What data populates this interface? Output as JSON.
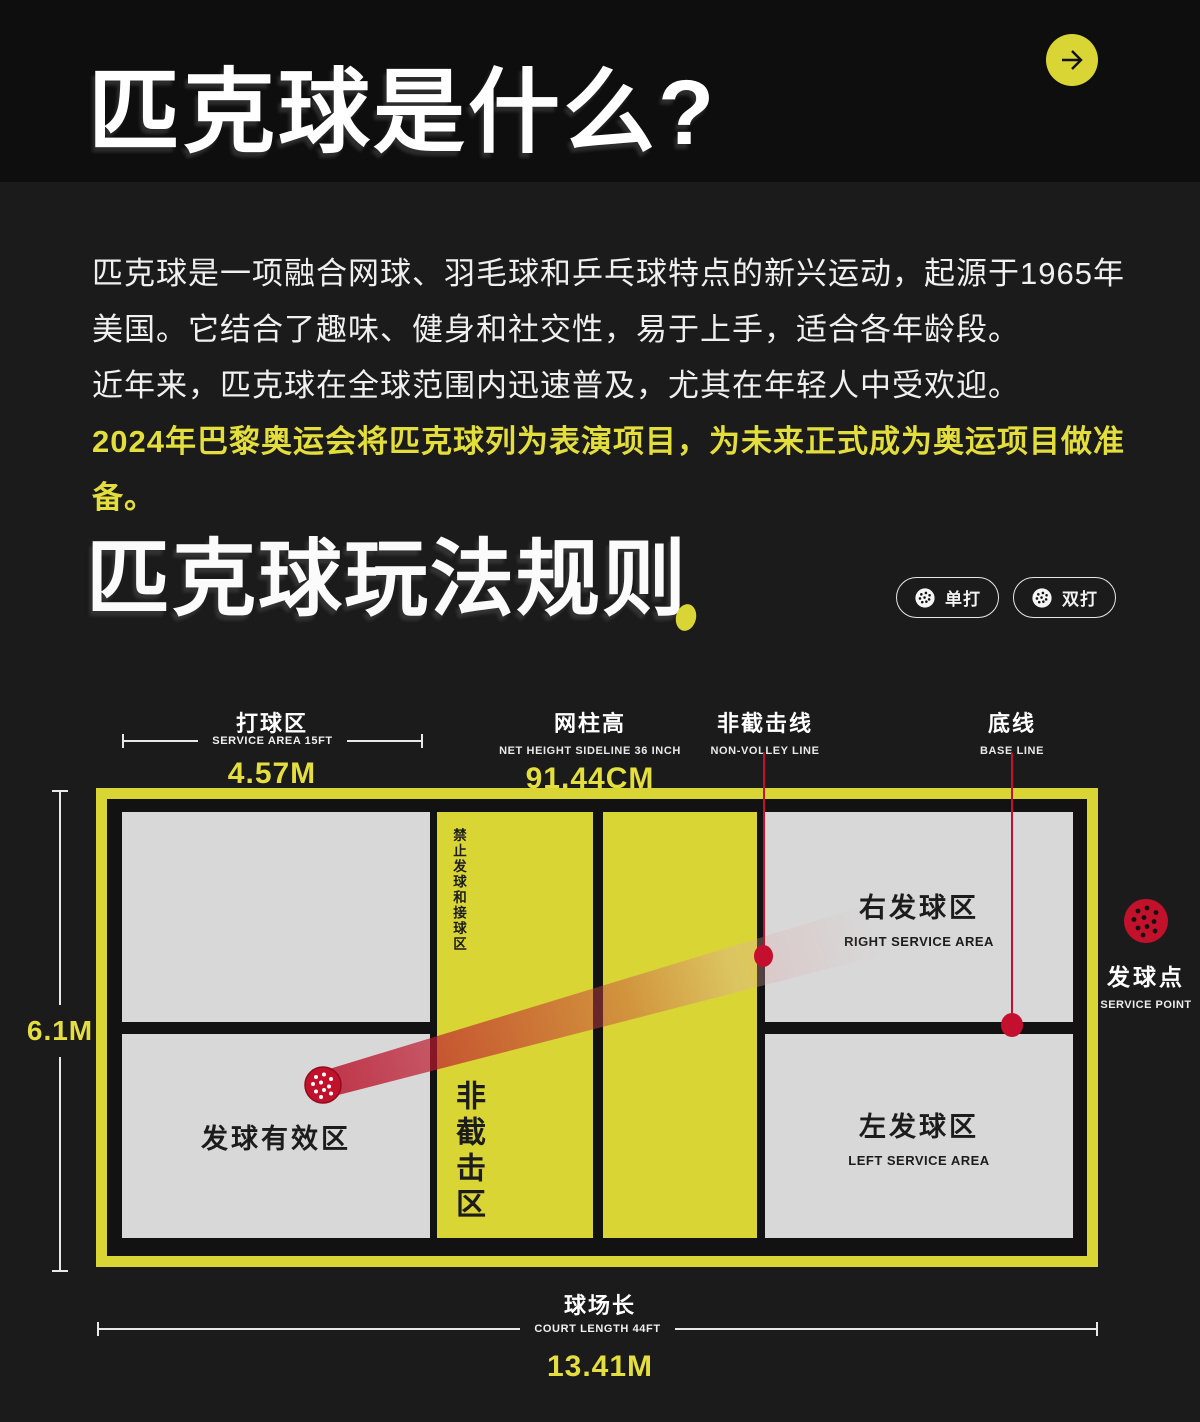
{
  "header": {
    "title": "匹克球是什么?"
  },
  "intro": {
    "line1": "匹克球是一项融合网球、羽毛球和乒乓球特点的新兴运动，起源于1965年",
    "line2": "美国。它结合了趣味、健身和社交性，易于上手，适合各年龄段。",
    "line3": "近年来，匹克球在全球范围内迅速普及，尤其在年轻人中受欢迎。",
    "highlight": "2024年巴黎奥运会将匹克球列为表演项目，为未来正式成为奥运项目做准备。"
  },
  "rules_section": {
    "title": "匹克球玩法规则",
    "singles_label": "单打",
    "doubles_label": "双打"
  },
  "measurements": {
    "service_area": {
      "cn": "打球区",
      "en": "SERVICE AREA 15FT",
      "metric": "4.57M"
    },
    "net_height": {
      "cn": "网柱高",
      "en": "NET HEIGHT SIDELINE 36 INCH",
      "metric": "91.44CM"
    },
    "non_volley_line": {
      "cn": "非截击线",
      "en": "NON-VOLLEY LINE"
    },
    "base_line": {
      "cn": "底线",
      "en": "BASE LINE"
    },
    "court_width_metric": "6.1M",
    "court_length": {
      "cn": "球场长",
      "en": "COURT LENGTH 44FT",
      "metric": "13.41M"
    },
    "service_point": {
      "cn": "发球点",
      "en": "SERVICE POINT"
    }
  },
  "court_zones": {
    "no_serve_receive_zone": "禁止发球和接球区",
    "non_volley_zone": "非截击区",
    "valid_serve_zone": "发球有效区",
    "right_service_area": {
      "cn": "右发球区",
      "en": "RIGHT SERVICE AREA"
    },
    "left_service_area": {
      "cn": "左发球区",
      "en": "LEFT SERVICE AREA"
    }
  },
  "colors": {
    "accent_yellow": "#d9d535",
    "metric_yellow": "#e4df3e",
    "court_gray": "#d8d8d8",
    "annotation_red": "#c40f2e",
    "page_bg": "#1b1b1b",
    "header_bg": "#0e0e0e"
  }
}
